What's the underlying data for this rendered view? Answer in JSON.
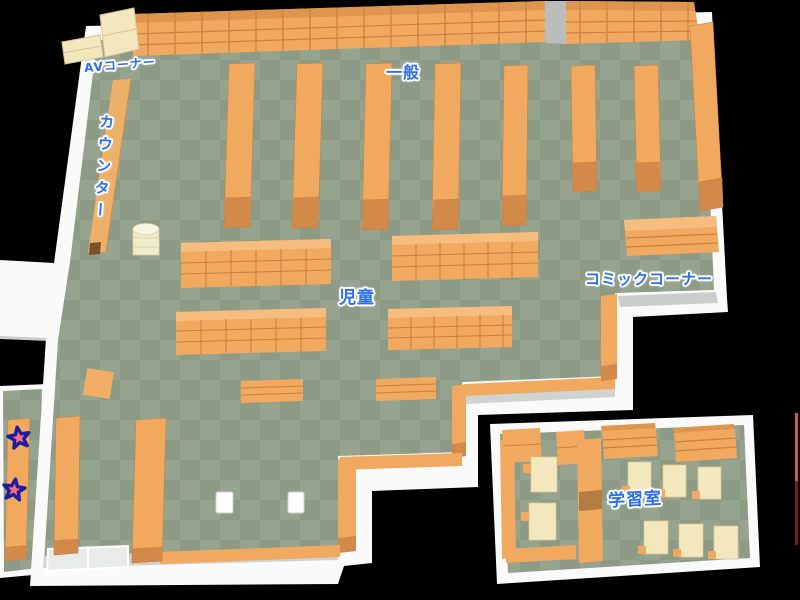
{
  "app": {
    "title": "Library floor map"
  },
  "map": {
    "areas": [
      {
        "id": "av-corner",
        "label": "AVコーナー"
      },
      {
        "id": "general",
        "label": "一般"
      },
      {
        "id": "counter",
        "label": "カウンター"
      },
      {
        "id": "children",
        "label": "児童"
      },
      {
        "id": "comic-corner",
        "label": "コミックコーナー"
      },
      {
        "id": "study-room",
        "label": "学習室"
      }
    ],
    "markers": [
      {
        "id": "star-marker-1",
        "type": "star",
        "fill": "#f56e86",
        "outline": "#1d1d9e"
      },
      {
        "id": "star-marker-2",
        "type": "star",
        "fill": "#f56e86",
        "outline": "#1d1d9e"
      }
    ],
    "colors": {
      "background": "#000000",
      "floor_light": "#96a38e",
      "floor_dark": "#8d9a85",
      "wall": "#fafafa",
      "wall_shadow": "#c9cdcb",
      "shelf": "#f1a95f",
      "shelf_dark": "#d2894a",
      "shelf_line": "#c9823f",
      "desk_cream": "#f3e7bd",
      "counter_tan": "#ecb168",
      "label_blue": "#2b6ef0"
    }
  }
}
